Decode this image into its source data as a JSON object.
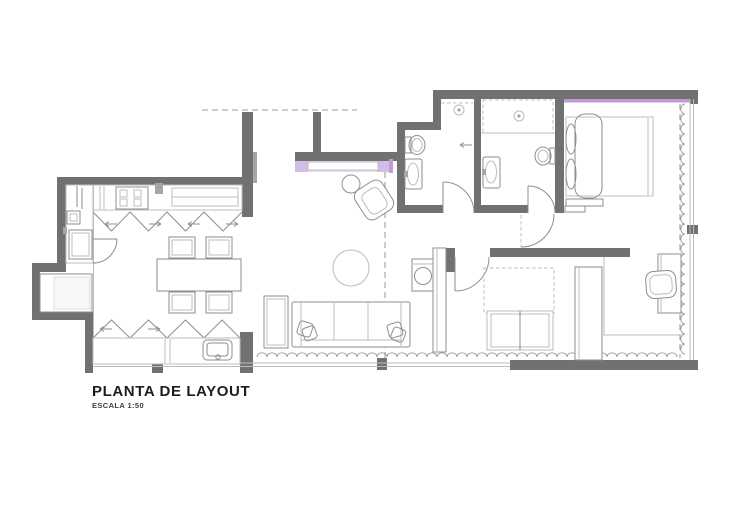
{
  "title": {
    "heading": "PLANTA DE LAYOUT",
    "subheading": "ESCALA 1:50"
  },
  "scale": "1:50",
  "colors": {
    "wall": "#717171",
    "wall_light": "#a6a6a6",
    "line": "#bcbcbc",
    "line_dark": "#8e8e8e",
    "accent_lilac": "#e7dbf1",
    "accent_lilac_dark": "#d3bce6",
    "accent_violet": "#c49ad1",
    "text": "#1d1d1b",
    "background": "#ffffff"
  },
  "plan": {
    "drawing_type": "apartment-layout-floor-plan",
    "rooms": [
      "kitchen",
      "laundry-area",
      "dining-area",
      "living-room",
      "entry-hall",
      "bathroom",
      "ensuite-bathroom",
      "bedroom-suite",
      "second-bedroom",
      "home-office-corner"
    ],
    "elements": [
      "cooktop-icon",
      "kitchen-counter",
      "kitchen-sink-icon",
      "folding-doors-icon",
      "washing-area-icon",
      "dining-table",
      "dining-chairs",
      "sofa",
      "throw-pillows",
      "armchair",
      "round-rug",
      "side-table",
      "console-highlight",
      "toilet-icon",
      "washbasin-icon",
      "shower-light-icon",
      "door-swing-arc",
      "double-bed",
      "pillows",
      "foot-bench",
      "canopy-projection",
      "wardrobe",
      "desk",
      "desk-chair",
      "curtain-icon",
      "window-glass",
      "ceiling-projection-dashed-line"
    ],
    "accents": [
      {
        "name": "console-highlight-band",
        "color": "#e7dbf1"
      },
      {
        "name": "bedroom-wall-highlight-strip",
        "color": "#c49ad1"
      }
    ]
  }
}
